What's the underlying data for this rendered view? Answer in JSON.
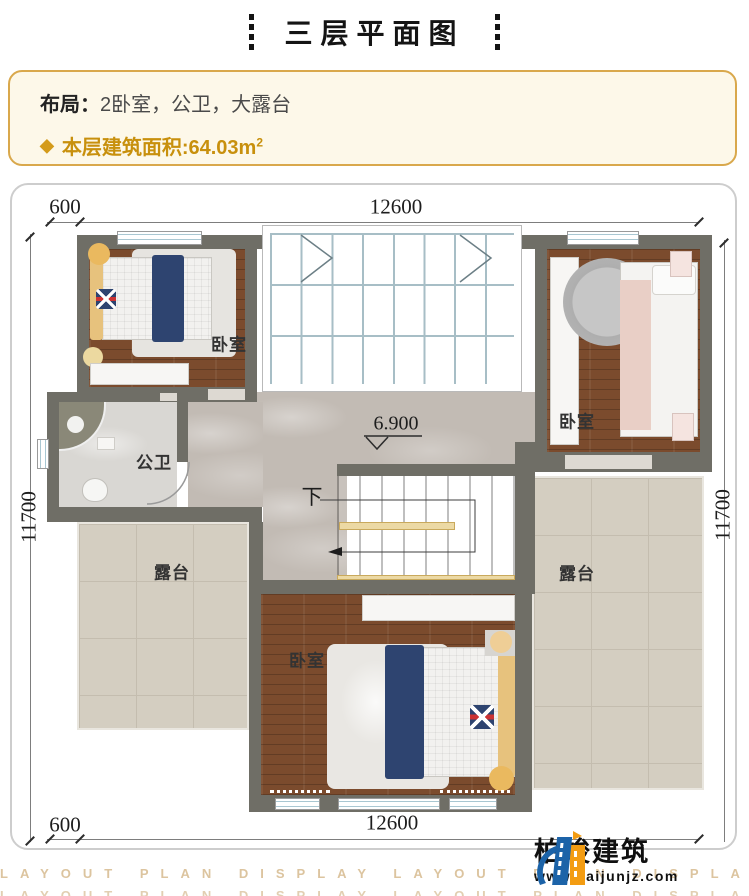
{
  "title": "三层平面图",
  "info": {
    "layout_label": "布局：",
    "layout_value": "2卧室，公卫，大露台",
    "area_bullet": "◆",
    "area_text": "本层建筑面积:64.03m",
    "area_sup": "2"
  },
  "dimensions": {
    "top_offset": "600",
    "top_main": "12600",
    "left": "11700",
    "right": "11700",
    "bottom_offset": "600",
    "bottom_main": "12600",
    "elevation": "6.900",
    "stairs_down": "下"
  },
  "rooms": {
    "bedroom_top_left": "卧室",
    "bedroom_top_right": "卧室",
    "bedroom_bottom": "卧室",
    "bathroom": "公卫",
    "terrace_left": "露台",
    "terrace_right": "露台"
  },
  "footer": {
    "watermark": "LAYOUT PLAN DISPLAY LAYOUT PLAN DISPLAY LAYOUT PLAN DISPLAY",
    "logo_name": "柏竣建筑",
    "logo_url": "www.baijunjz.com"
  },
  "colors": {
    "accent_gold": "#c8900d",
    "info_border": "#d9a84c",
    "wall": "#6f6e66",
    "wood_floor": "#7b4b2d",
    "marble_floor": "#c2bbb4",
    "terrace_tile": "#d4cec1",
    "skylight_glass": "#e7f2f6",
    "bed_navy": "#2e4470",
    "logo_blue": "#1c63a8",
    "logo_orange": "#f39c12"
  }
}
